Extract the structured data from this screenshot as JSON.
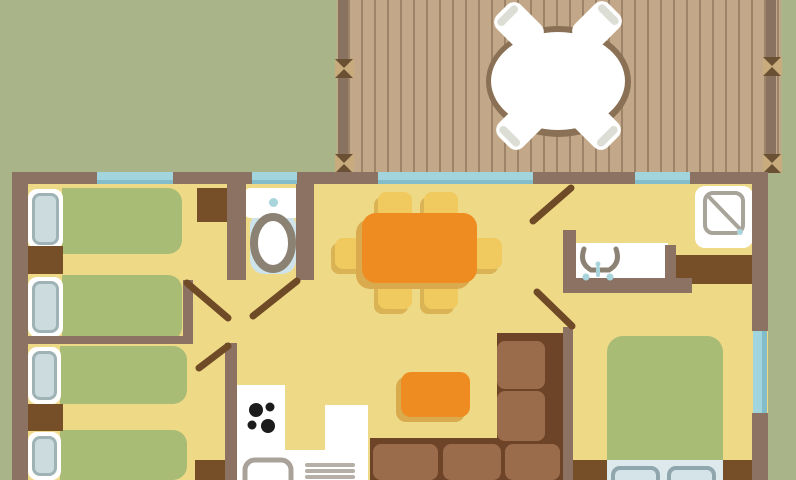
{
  "title": "Holiday home floor plan with terrace",
  "palette": {
    "bg": "#a9b489",
    "deck": "#c2a888",
    "deck_line": "#9d8468",
    "rail": "#8a7260",
    "post": "#c8ac7d",
    "post_x": "#6b5134",
    "ring": "#8a7055",
    "wall": "#8b7263",
    "floor": "#eed987",
    "window": "#a2d4de",
    "window_edge": "#83bdc9",
    "white": "#ffffff",
    "chair_cap": "#dcded6",
    "bed_green": "#a8bc75",
    "pillow_in": "#ccdcde",
    "pillow_edge": "#9fb2b6",
    "sheet": "#dde9ec",
    "mpillow": "#d5e4e8",
    "mpillow_edge": "#8fa6ac",
    "dark": "#764f29",
    "door": "#6f4a26",
    "orange": "#ee8c22",
    "shadow_orange": "#d9aa4e",
    "chair": "#f0ca5e",
    "shadow_chair": "#d9b354",
    "sofa_base": "#6d4428",
    "sofa_cushion": "#9b6c4c",
    "fixture": "#8b8274",
    "shower_gray": "#a9a49a",
    "counter_gray": "#a8a29a",
    "rack_gray": "#b5afa7",
    "wc_blue": "#cfe4ea",
    "drop_blue": "#a8d4dc",
    "stove": "#1c1c1c"
  },
  "deck": {
    "name": "terrace",
    "railing_posts": 4,
    "furniture": [
      {
        "name": "round-patio-table",
        "seats": 4
      },
      {
        "name": "patio-chair",
        "count": 4
      }
    ]
  },
  "rooms": [
    {
      "name": "twin-bedroom-1",
      "furniture": [
        "single-bed",
        "single-bed",
        "nightstand",
        "closet"
      ]
    },
    {
      "name": "twin-bedroom-2",
      "furniture": [
        "single-bed",
        "single-bed",
        "nightstand",
        "wardrobe"
      ]
    },
    {
      "name": "wc",
      "furniture": [
        "toilet"
      ]
    },
    {
      "name": "dining-area",
      "furniture": [
        "dining-table",
        "chair x6"
      ]
    },
    {
      "name": "kitchen",
      "furniture": [
        "u-shaped-counter",
        "hob-4-burners",
        "sink",
        "dish-rack"
      ]
    },
    {
      "name": "living-area",
      "furniture": [
        "corner-sofa",
        "coffee-table"
      ]
    },
    {
      "name": "bathroom",
      "furniture": [
        "shower",
        "washbasin-counter",
        "cabinet"
      ]
    },
    {
      "name": "double-bedroom",
      "furniture": [
        "double-bed",
        "nightstand",
        "nightstand"
      ]
    }
  ],
  "windows_count": 5,
  "interior_doors_count": 5
}
